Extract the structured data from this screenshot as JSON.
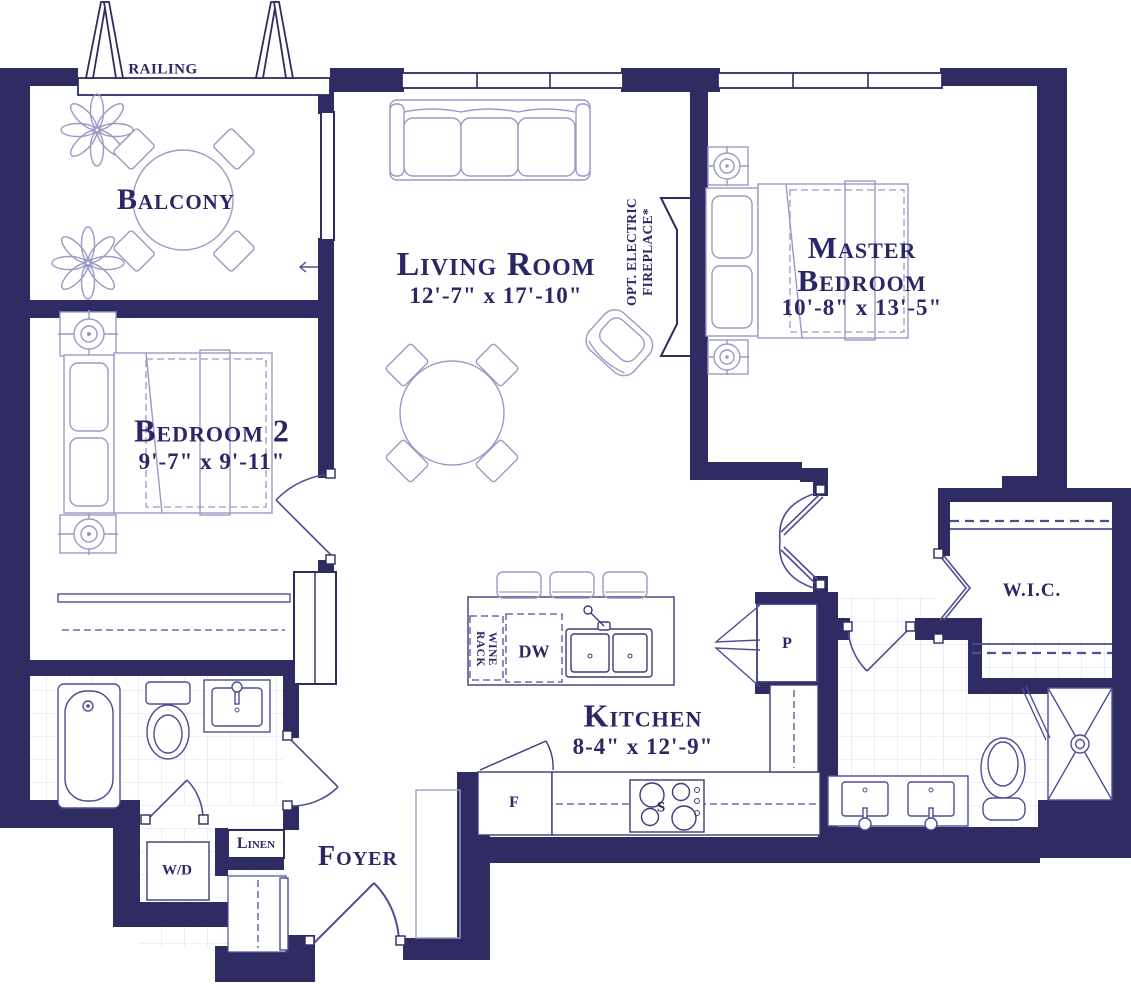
{
  "colors": {
    "wall": "#2f2b63",
    "furn": "#9b99c6",
    "ink": "#2b2766",
    "fix": "#514d93",
    "cnt": "#3e3a78",
    "tile": "#e4e3f0"
  },
  "rooms": {
    "balcony": {
      "name": "Balcony"
    },
    "living_room": {
      "name": "Living Room",
      "dims": "12'-7\" x 17'-10\""
    },
    "master_bedroom": {
      "name_line1": "Master",
      "name_line2": "Bedroom",
      "dims": "10'-8\" x 13'-5\""
    },
    "bedroom_2": {
      "name": "Bedroom 2",
      "dims": "9'-7\" x 9'-11\""
    },
    "kitchen": {
      "name": "Kitchen",
      "dims": "8-4\" x 12'-9\""
    },
    "wic": {
      "name": "W.I.C."
    },
    "foyer": {
      "name": "Foyer"
    }
  },
  "annotations": {
    "railing": "RAILING",
    "opt_fireplace_line1": "OPT. ELECTRIC",
    "opt_fireplace_line2": "FIREPLACE*",
    "wine_rack_line1": "WINE",
    "wine_rack_line2": "RACK",
    "dishwasher": "DW",
    "pantry": "P",
    "fridge": "F",
    "stove": "S",
    "washer_dryer": "W/D",
    "linen": "Linen"
  }
}
